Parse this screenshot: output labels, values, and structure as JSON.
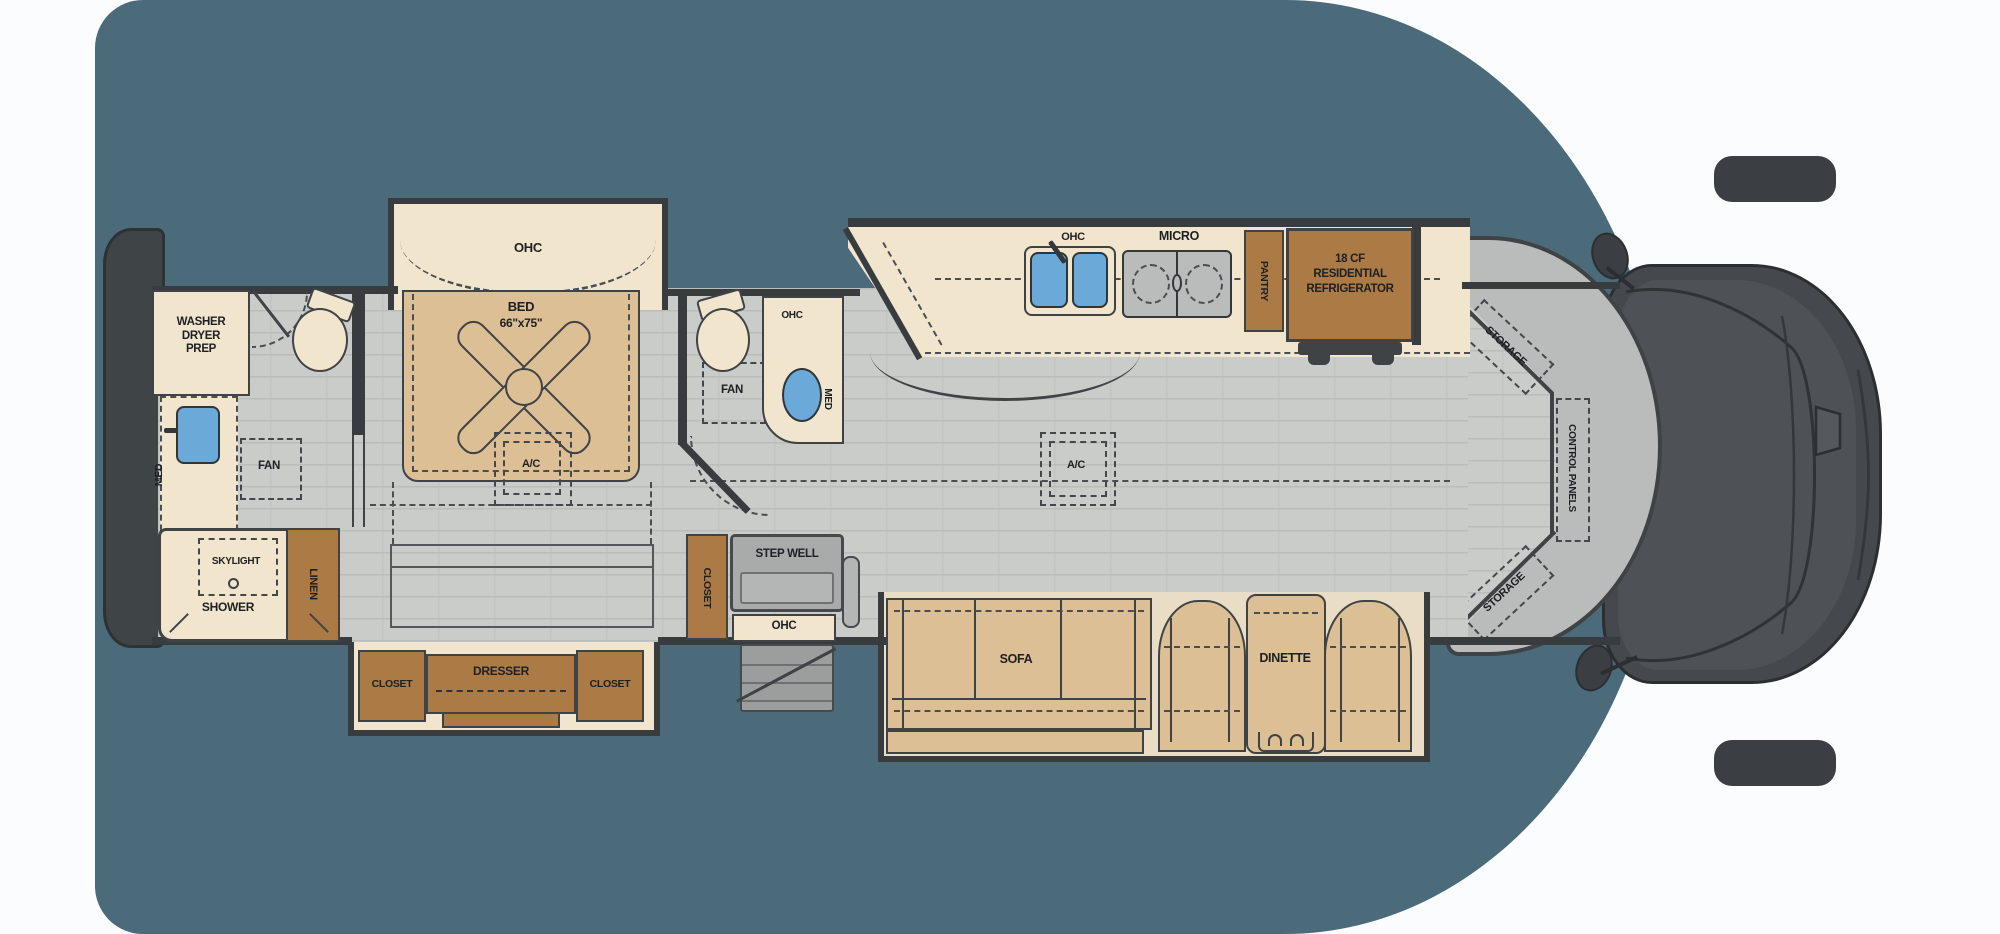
{
  "colors": {
    "background_panel": "#4b6b7a",
    "floor_gray": "#c9ccc9",
    "slide_cream": "#f1e5cd",
    "furniture_tan": "#dcbf94",
    "cabinet_brown": "#ab7a45",
    "sink_blue": "#6aa9d8",
    "wall_dark": "#383c3f",
    "cockpit_gray": "#b9bcba",
    "cab_dark": "#45494d"
  },
  "labels": {
    "rear_bath": {
      "washer_dryer_prep": "WASHER\nDRYER\nPREP",
      "med": "MED",
      "fan": "FAN",
      "skylight": "SKYLIGHT",
      "shower": "SHOWER",
      "linen": "LINEN"
    },
    "bedroom": {
      "ohc": "OHC",
      "bed": "BED",
      "bed_size": "66\"x75\"",
      "ac": "A/C",
      "closet_left": "CLOSET",
      "dresser": "DRESSER",
      "closet_right": "CLOSET"
    },
    "mid_bath": {
      "ohc": "OHC",
      "fan": "FAN",
      "med": "MED"
    },
    "kitchen": {
      "ohc": "OHC",
      "micro": "MICRO",
      "pantry": "PANTRY",
      "refrigerator": "18 CF\nRESIDENTIAL\nREFRIGERATOR"
    },
    "living": {
      "ac": "A/C",
      "sofa": "SOFA",
      "dinette": "DINETTE"
    },
    "entry": {
      "closet": "CLOSET",
      "step_well": "STEP WELL",
      "ohc": "OHC"
    },
    "cockpit": {
      "storage_top": "STORAGE",
      "control_panels": "CONTROL PANELS",
      "storage_bottom": "STORAGE"
    }
  }
}
